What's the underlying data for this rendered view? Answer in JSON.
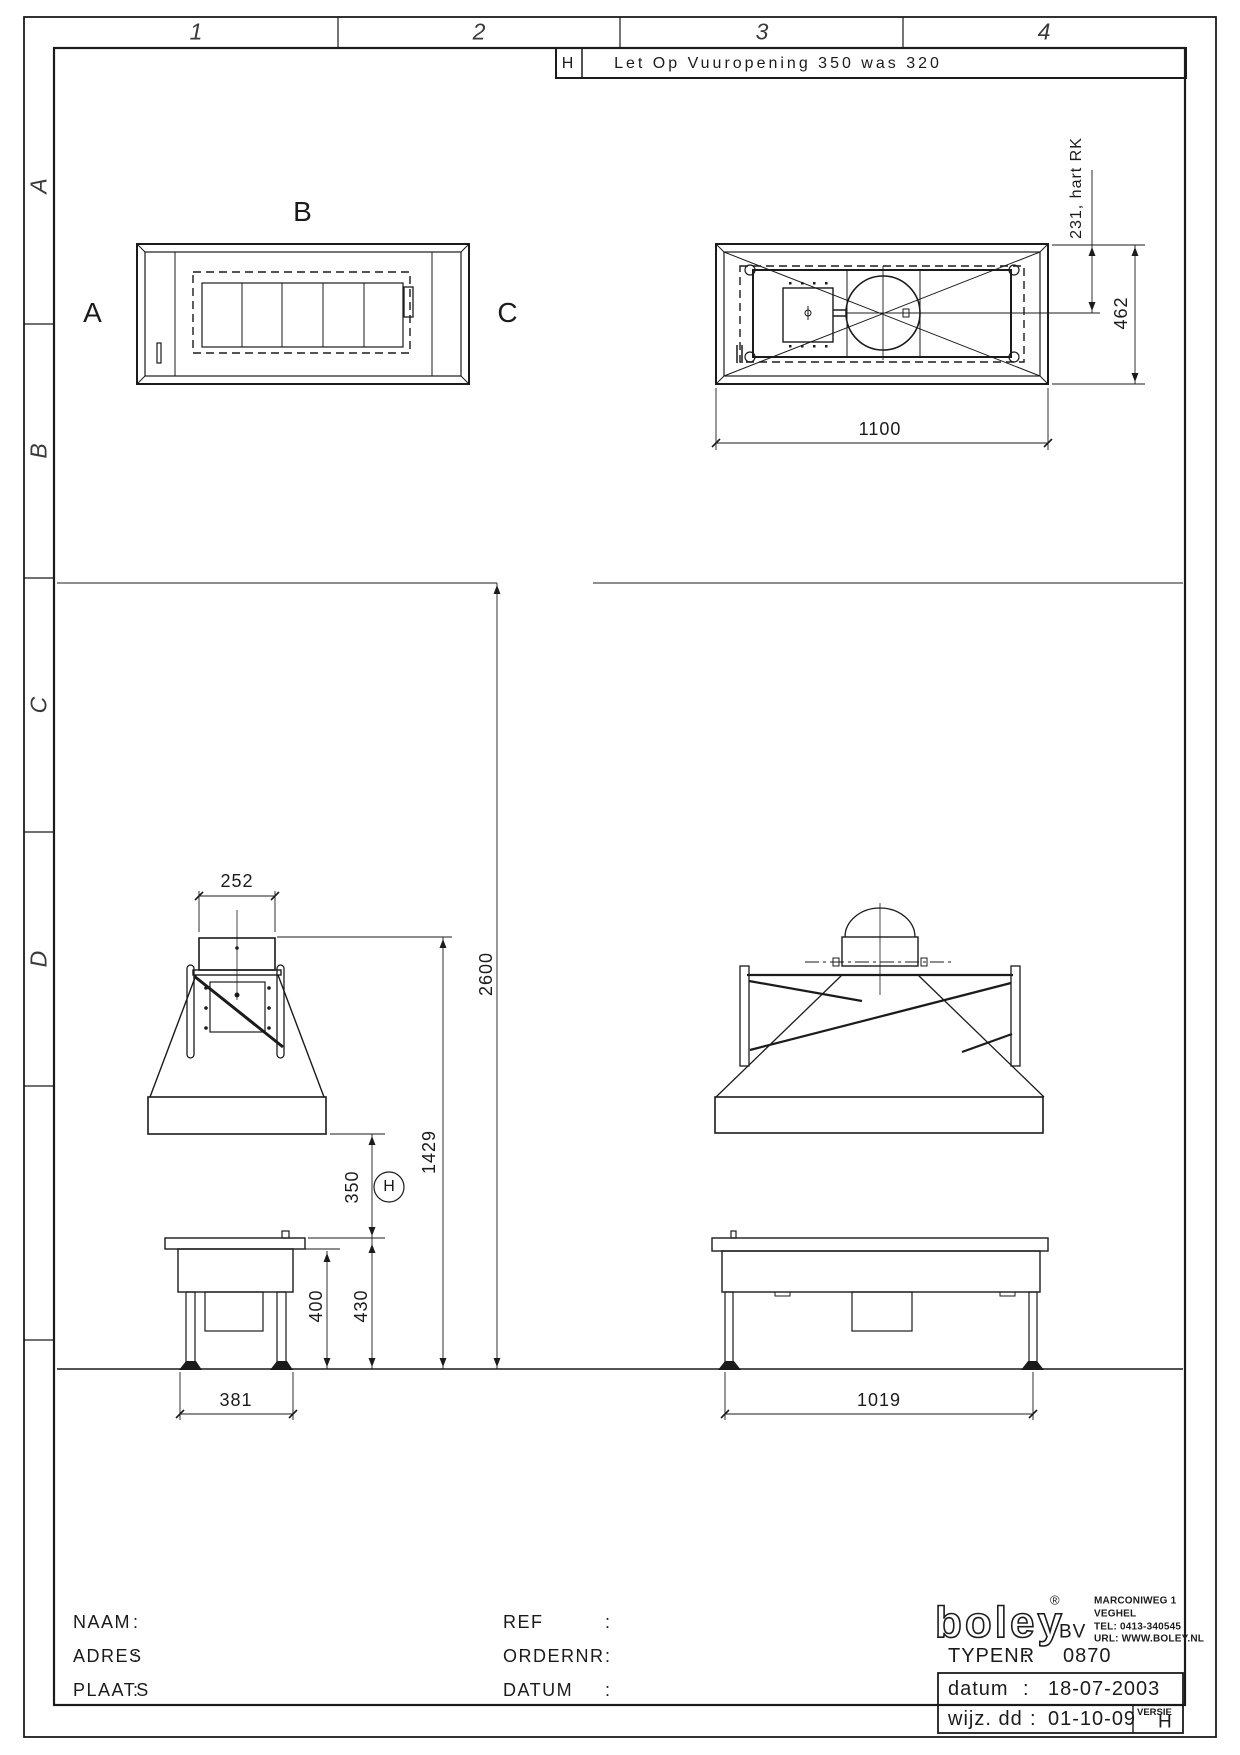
{
  "frame": {
    "columns": [
      "1",
      "2",
      "3",
      "4"
    ],
    "rows": [
      "A",
      "B",
      "C",
      "D"
    ]
  },
  "revision_note": {
    "marker": "H",
    "text": "Let Op Vuuropening 350 was 320"
  },
  "view_labels": {
    "left": "A",
    "top": "B",
    "right": "C"
  },
  "dims": {
    "plan_width": "1100",
    "plan_depth": "462",
    "flue_center": "231, hart RK",
    "duct_width": "252",
    "ceiling_height": "2600",
    "hood_top_height": "1429",
    "hood_gap": "350",
    "table_clearance": "400",
    "table_height": "430",
    "front_leg_span": "381",
    "side_leg_span": "1019",
    "revision_marker": "H"
  },
  "title_block": {
    "colon": ":",
    "naam_label": "NAAM",
    "adres_label": "ADRES",
    "plaats_label": "PLAATS",
    "ref_label": "REF",
    "ordernr_label": "ORDERNR",
    "datum_label": "DATUM",
    "logo_text": "boley",
    "registered_mark": "®",
    "logo_suffix": "BV",
    "address_lines": [
      "MARCONIWEG 1",
      "VEGHEL",
      "TEL: 0413-340545",
      "URL: WWW.BOLEY.NL"
    ],
    "typenr_label": "TYPENR",
    "typenr_value": "0870",
    "datum_row_label": "datum",
    "datum_row_value": "18-07-2003",
    "wijz_label": "wijz. dd",
    "wijz_value": "01-10-09",
    "versie_label": "VERSIE",
    "versie_value": "H"
  }
}
